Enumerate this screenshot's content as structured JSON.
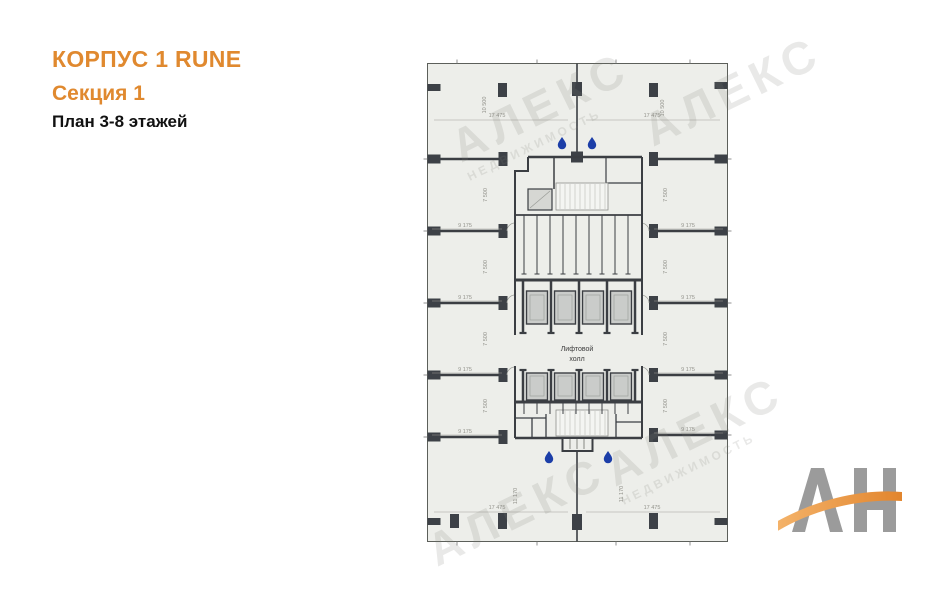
{
  "header": {
    "building_title": "КОРПУС 1 RUNE",
    "section_title": "Секция 1",
    "floors_subtitle": "План 3-8 этажей"
  },
  "plan": {
    "elevator_hall": {
      "line1": "Лифтовой",
      "line2": "холл"
    },
    "dimensions": {
      "w_top": "17 475",
      "h_top": "10 500",
      "room_w": "9 175",
      "room_h": "7 500",
      "h_bottom": "11 170",
      "w_bottom": "17 475"
    }
  },
  "watermark": {
    "title": "АЛЕКС",
    "subtitle": "НЕДВИЖИМОСТЬ"
  },
  "logo": {
    "letters": "АН"
  },
  "colors": {
    "accent_orange": "#e0892f",
    "plan_fill": "#edeeea",
    "wall_dark": "#3b3e43",
    "water_drop_blue": "#1c3ea8",
    "logo_gray": "#9b9b9b",
    "logo_orange": "#ec9c4b"
  }
}
